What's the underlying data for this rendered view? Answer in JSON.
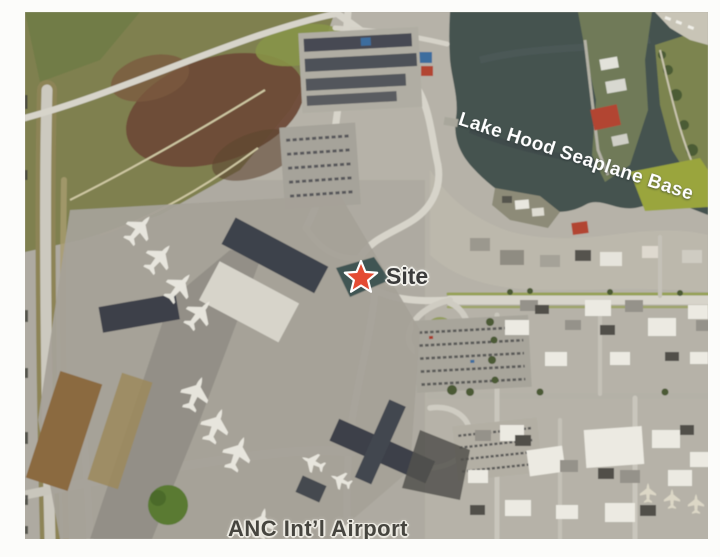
{
  "figure": {
    "type": "scanned-aerial-photo-map",
    "location_labels": {
      "seaplane_base": "Lake Hood Seaplane Base",
      "site": "Site",
      "airport": "ANC Int’l Airport"
    },
    "marker": {
      "icon": "site-star-icon",
      "shape": "5-point-star",
      "fill": "#e44b33",
      "outline": "#ffffff"
    },
    "colors": {
      "page_margin": "#fcfcfa",
      "water": "#455250",
      "land": "#b6b2a8",
      "roads": "#d7d4ca",
      "vegetation": "#7f8050",
      "marsh_brown": "#6e4b36",
      "terminal_roof": "#3e424b",
      "bright_grass": "#9aa53e",
      "site_label_color": "#3b3b3b",
      "airport_label_color": "#46453f",
      "lake_label_color": "#ffffff"
    }
  }
}
